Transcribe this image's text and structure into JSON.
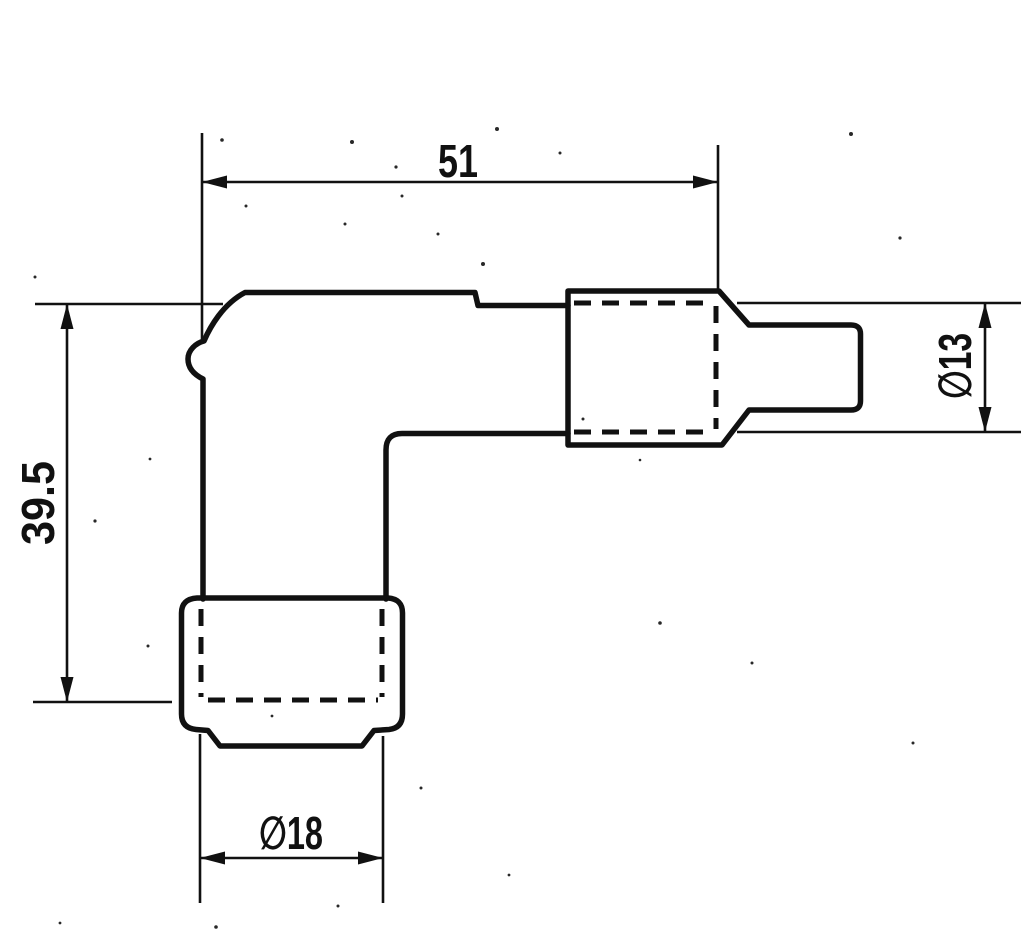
{
  "drawing": {
    "background_color": "#ffffff",
    "ink_color": "#111111",
    "labels": {
      "length_top": "51",
      "height_left": "39.5",
      "dia_terminal": "∅13",
      "dia_boot": "∅18"
    }
  }
}
